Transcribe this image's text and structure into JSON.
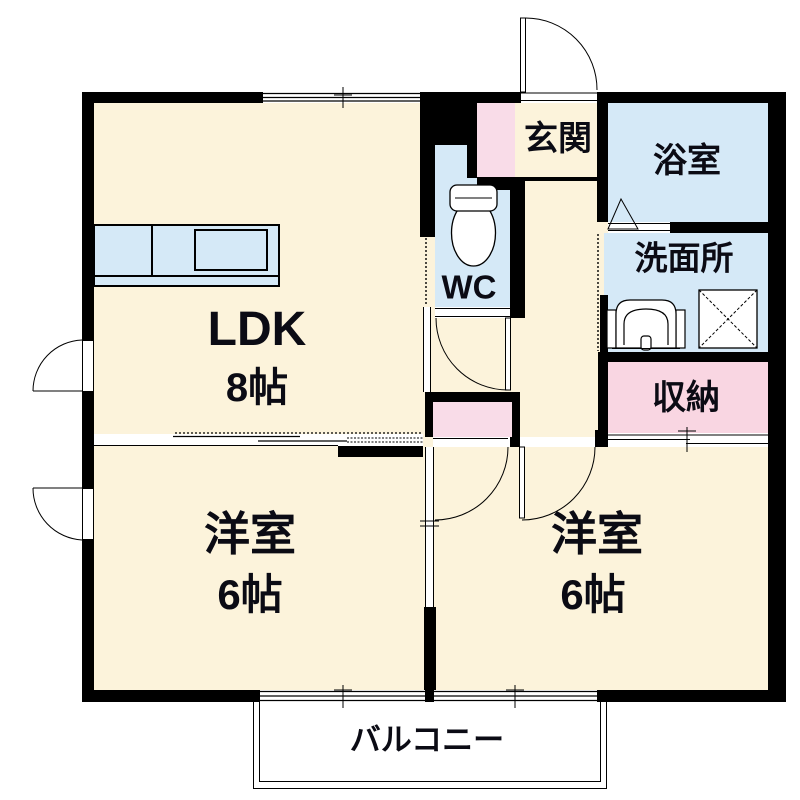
{
  "title": "apartment-floor-plan",
  "rooms": {
    "ldk": {
      "label": "LDK",
      "size": "8帖"
    },
    "bedroom_left": {
      "label": "洋室",
      "size": "6帖"
    },
    "bedroom_right": {
      "label": "洋室",
      "size": "6帖"
    },
    "entrance": {
      "label": "玄関"
    },
    "bath": {
      "label": "浴室"
    },
    "washroom": {
      "label": "洗面所"
    },
    "toilet": {
      "label": "WC"
    },
    "storage": {
      "label": "収納"
    },
    "balcony": {
      "label": "バルコニー"
    }
  },
  "fixtures": {
    "toilet_icon": "toilet-icon",
    "washbasin_icon": "sink-icon",
    "washing_machine_icon": "washing-machine-icon",
    "kitchen_counter_icon": "kitchen-counter-icon",
    "door_arcs": "door-swing-arc",
    "bath_door": "folding-door-triangle",
    "sliding_doors": "sliding-door-lines"
  },
  "colors": {
    "room_fill": "#FCF3DB",
    "wet_area_fill": "#D5E9F7",
    "storage_fill": "#F9D6E2",
    "wall": "#000000",
    "line": "#1a1a1a",
    "background": "#ffffff"
  }
}
